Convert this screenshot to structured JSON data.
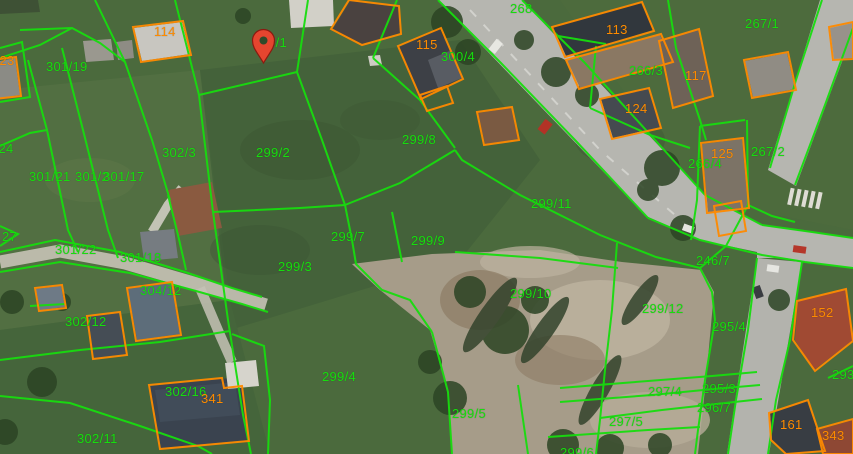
{
  "map": {
    "type": "cadastral-aerial-map",
    "parcel_line_color": "#17dd0e",
    "building_line_color": "#ff8a00",
    "parcel_label_color": "#17dd0e",
    "building_label_color": "#ff8a00",
    "marker_color": "#e5452f",
    "marker": {
      "x": 263,
      "y": 63
    },
    "parcel_labels": [
      {
        "text": "301/19",
        "x": 46,
        "y": 60
      },
      {
        "text": "299/1",
        "x": 253,
        "y": 36
      },
      {
        "text": "302/3",
        "x": 162,
        "y": 146
      },
      {
        "text": "299/2",
        "x": 256,
        "y": 146
      },
      {
        "text": "299/8",
        "x": 402,
        "y": 133
      },
      {
        "text": "300/4",
        "x": 441,
        "y": 50
      },
      {
        "text": "268",
        "x": 510,
        "y": 2
      },
      {
        "text": "267/1",
        "x": 745,
        "y": 17
      },
      {
        "text": "266/3",
        "x": 629,
        "y": 64
      },
      {
        "text": "267/2",
        "x": 751,
        "y": 145
      },
      {
        "text": "266/4",
        "x": 688,
        "y": 157
      },
      {
        "text": "299/11",
        "x": 531,
        "y": 197
      },
      {
        "text": "301/24",
        "x": -28,
        "y": 142
      },
      {
        "text": "301/21",
        "x": 29,
        "y": 170
      },
      {
        "text": "301/2",
        "x": 75,
        "y": 170
      },
      {
        "text": "301/17",
        "x": 103,
        "y": 170
      },
      {
        "text": "27",
        "x": 2,
        "y": 230
      },
      {
        "text": "301/22",
        "x": 55,
        "y": 243
      },
      {
        "text": "301/18",
        "x": 120,
        "y": 251
      },
      {
        "text": "304/12",
        "x": 140,
        "y": 284
      },
      {
        "text": "302/12",
        "x": 65,
        "y": 315
      },
      {
        "text": "299/7",
        "x": 331,
        "y": 230
      },
      {
        "text": "299/9",
        "x": 411,
        "y": 234
      },
      {
        "text": "299/3",
        "x": 278,
        "y": 260
      },
      {
        "text": "299/10",
        "x": 510,
        "y": 287
      },
      {
        "text": "299/12",
        "x": 642,
        "y": 302
      },
      {
        "text": "295/4",
        "x": 712,
        "y": 320
      },
      {
        "text": "246/7",
        "x": 696,
        "y": 254
      },
      {
        "text": "299/4",
        "x": 322,
        "y": 370
      },
      {
        "text": "299/5",
        "x": 452,
        "y": 407
      },
      {
        "text": "297/5",
        "x": 609,
        "y": 415
      },
      {
        "text": "297/4",
        "x": 648,
        "y": 385
      },
      {
        "text": "295/3",
        "x": 702,
        "y": 382
      },
      {
        "text": "296/7",
        "x": 697,
        "y": 401
      },
      {
        "text": "302/11",
        "x": 77,
        "y": 432
      },
      {
        "text": "302/16",
        "x": 165,
        "y": 385
      },
      {
        "text": "299/6",
        "x": 560,
        "y": 446
      },
      {
        "text": "293",
        "x": 832,
        "y": 368
      }
    ],
    "building_labels": [
      {
        "text": "114",
        "x": 154,
        "y": 25
      },
      {
        "text": "115",
        "x": 416,
        "y": 38
      },
      {
        "text": "113",
        "x": 606,
        "y": 23
      },
      {
        "text": "117",
        "x": 685,
        "y": 69
      },
      {
        "text": "124",
        "x": 625,
        "y": 102
      },
      {
        "text": "125",
        "x": 711,
        "y": 147
      },
      {
        "text": "152",
        "x": 811,
        "y": 306
      },
      {
        "text": "161",
        "x": 780,
        "y": 418
      },
      {
        "text": "343",
        "x": 822,
        "y": 429
      },
      {
        "text": "341",
        "x": 201,
        "y": 392
      },
      {
        "text": "123",
        "x": -8,
        "y": 54
      }
    ]
  }
}
